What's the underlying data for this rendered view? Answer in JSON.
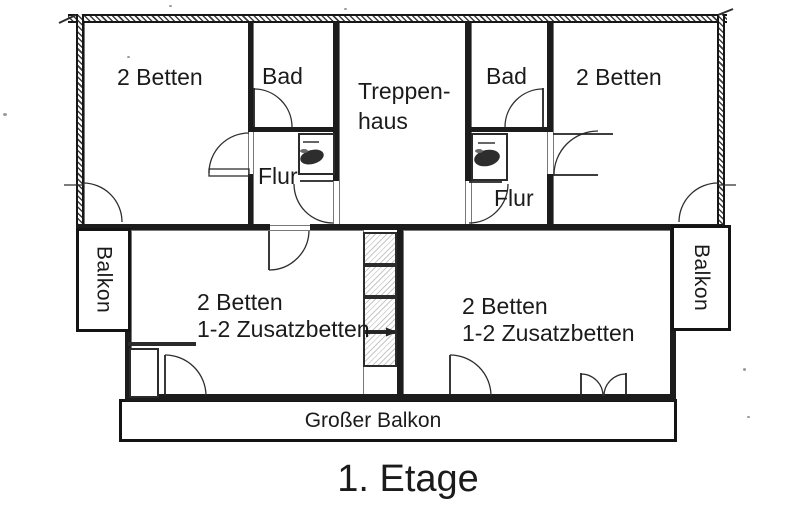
{
  "floor_plan": {
    "title": "1. Etage",
    "labels": {
      "room_top_left": "2 Betten",
      "bad_left": "Bad",
      "treppenhaus_line1": "Treppen-",
      "treppenhaus_line2": "haus",
      "bad_right": "Bad",
      "room_top_right": "2 Betten",
      "flur_left": "Flur",
      "flur_right": "Flur",
      "room_bottom_left_line1": "2 Betten",
      "room_bottom_left_line2": "1-2 Zusatzbetten",
      "room_bottom_right_line1": "2 Betten",
      "room_bottom_right_line2": "1-2 Zusatzbetten",
      "balcony_left": "Balkon",
      "balcony_right": "Balkon",
      "large_balcony": "Großer Balkon"
    },
    "colors": {
      "ink": "#1b1b1b",
      "background": "#ffffff"
    }
  }
}
